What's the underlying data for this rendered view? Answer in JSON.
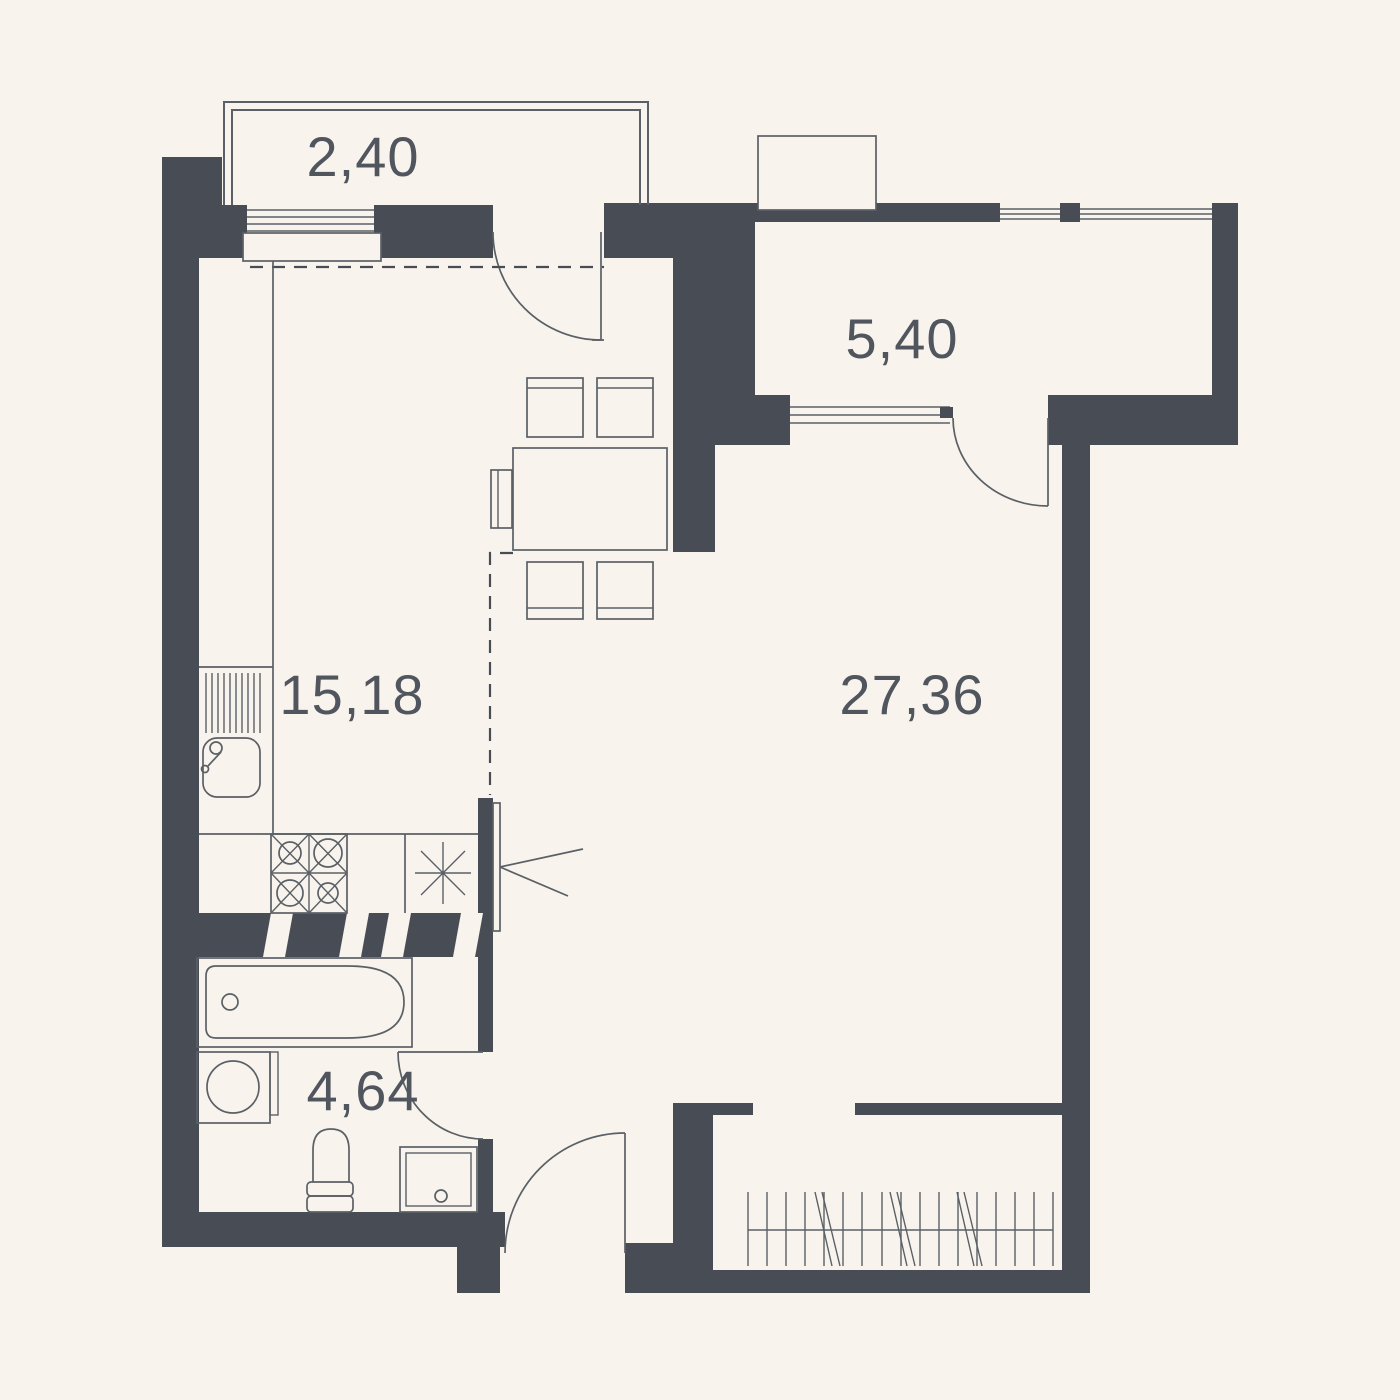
{
  "plan": {
    "type": "apartment-floor-plan",
    "colors": {
      "background": "#f8f4ed",
      "wall": "#484d55",
      "line": "#5a6066",
      "text": "#51565e"
    },
    "rooms": [
      {
        "id": "balcony",
        "name": "balcony-top-left",
        "area_label": "2,40"
      },
      {
        "id": "loggia",
        "name": "loggia-top-right",
        "area_label": "5,40"
      },
      {
        "id": "kitchen",
        "name": "kitchen-dining",
        "area_label": "15,18"
      },
      {
        "id": "living",
        "name": "living-room",
        "area_label": "27,36"
      },
      {
        "id": "bathroom",
        "name": "bathroom",
        "area_label": "4,64"
      }
    ]
  }
}
